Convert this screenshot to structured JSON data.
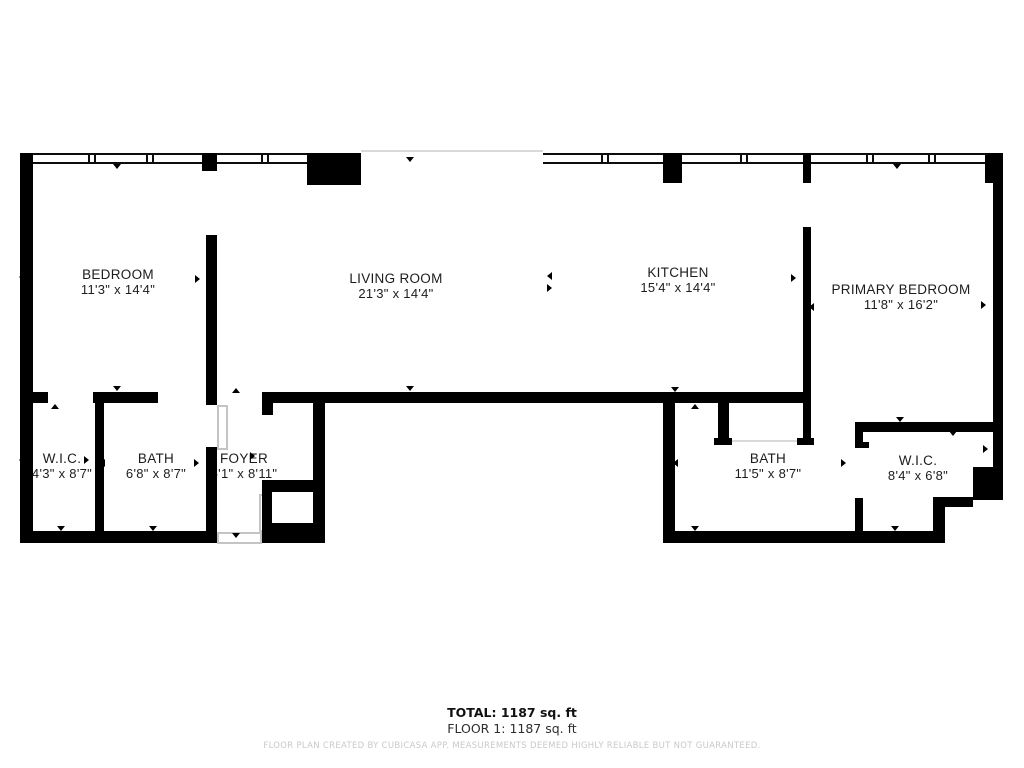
{
  "plan": {
    "rooms": {
      "bedroom": {
        "name": "BEDROOM",
        "dims": "11'3\" x 14'4\""
      },
      "living_room": {
        "name": "LIVING ROOM",
        "dims": "21'3\" x 14'4\""
      },
      "kitchen": {
        "name": "KITCHEN",
        "dims": "15'4\" x 14'4\""
      },
      "primary_bedroom": {
        "name": "PRIMARY BEDROOM",
        "dims": "11'8\" x 16'2\""
      },
      "wic_left": {
        "name": "W.I.C.",
        "dims": "4'3\" x 8'7\""
      },
      "bath_left": {
        "name": "BATH",
        "dims": "6'8\" x 8'7\""
      },
      "foyer": {
        "name": "FOYER",
        "dims": "5'1\" x 8'11\""
      },
      "bath_right": {
        "name": "BATH",
        "dims": "11'5\" x 8'7\""
      },
      "wic_right": {
        "name": "W.I.C.",
        "dims": "8'4\" x 6'8\""
      }
    },
    "footer": {
      "total": "TOTAL: 1187 sq. ft",
      "floor": "FLOOR 1: 1187 sq. ft",
      "disclaimer": "FLOOR PLAN CREATED BY CUBICASA APP. MEASUREMENTS DEEMED HIGHLY RELIABLE BUT NOT GUARANTEED."
    },
    "colors": {
      "wall": "#000000",
      "background": "#ffffff",
      "window_frame": "#0d0d0d",
      "door_outline": "#c4c4c4",
      "disclaimer_text": "#c9c9c9"
    }
  }
}
